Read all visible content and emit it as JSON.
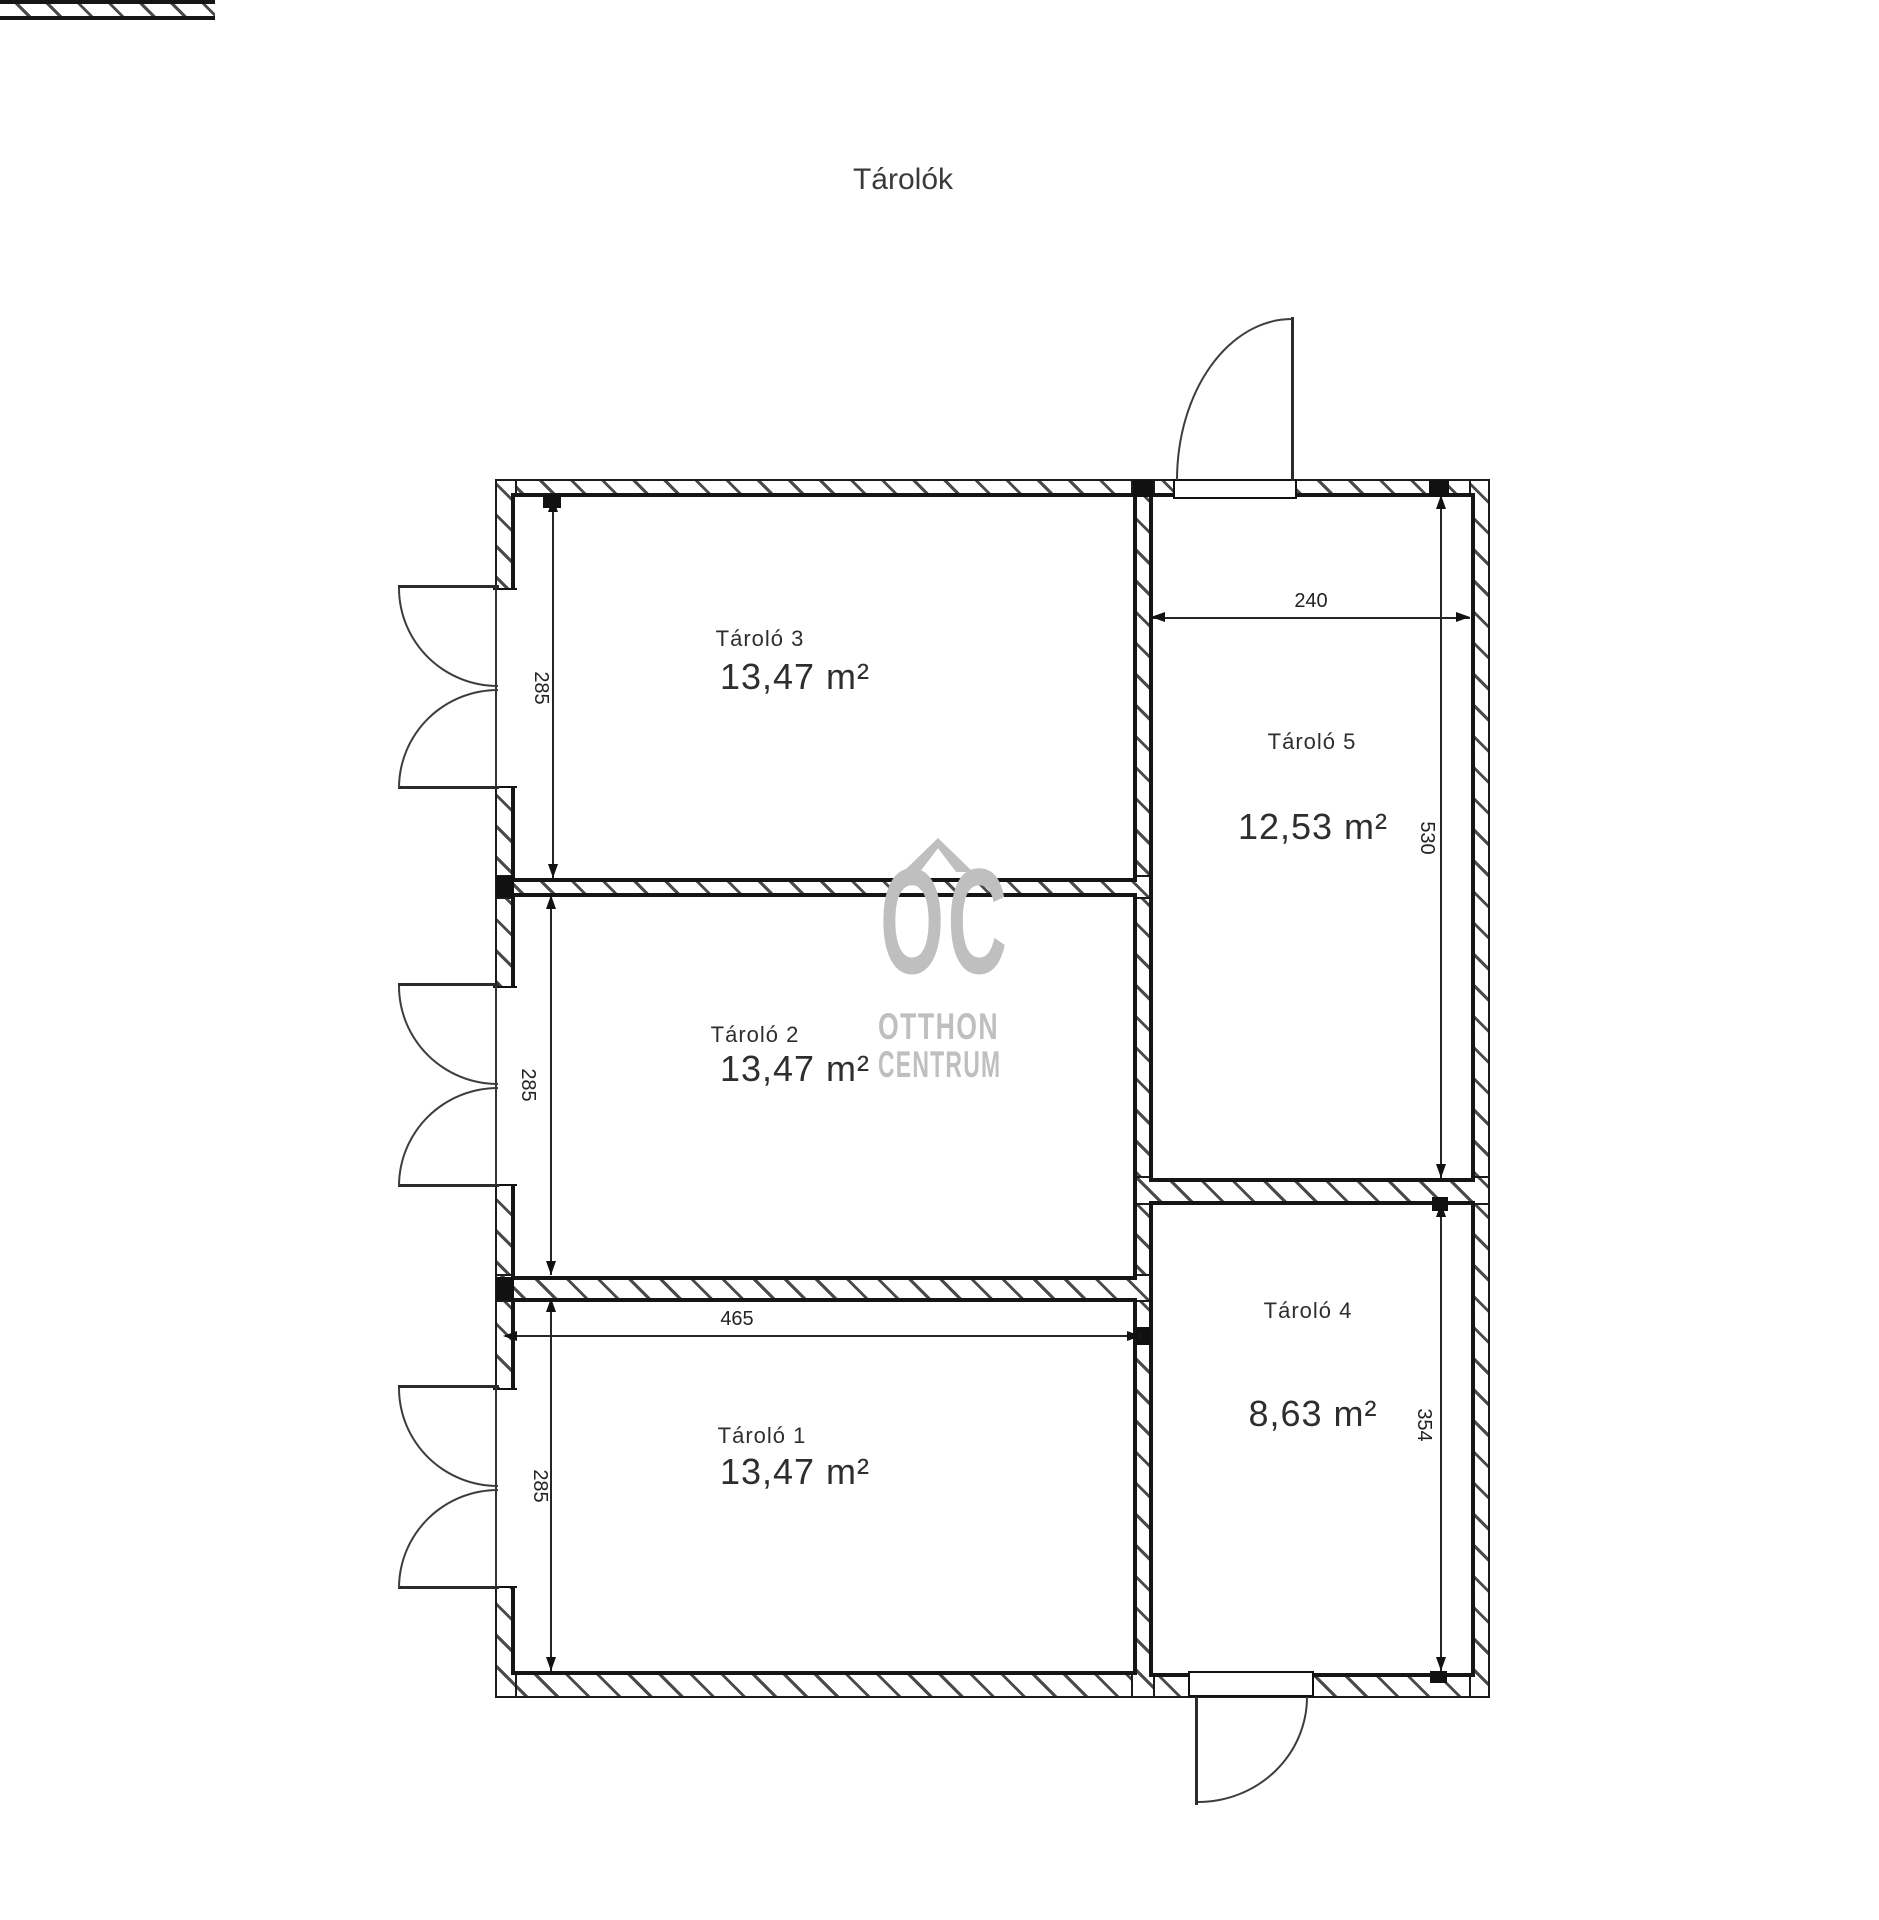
{
  "title": "Tárolók",
  "rooms": {
    "t1": {
      "name": "Tároló 1",
      "area": "13,47 m²"
    },
    "t2": {
      "name": "Tároló 2",
      "area": "13,47 m²"
    },
    "t3": {
      "name": "Tároló 3",
      "area": "13,47 m²"
    },
    "t4": {
      "name": "Tároló 4",
      "area": "8,63 m²"
    },
    "t5": {
      "name": "Tároló 5",
      "area": "12,53 m²"
    }
  },
  "dimensions": {
    "t3_height": "285",
    "t2_height": "285",
    "t1_height": "285",
    "t1_width": "465",
    "t5_width": "240",
    "t5_height": "530",
    "t4_height": "354"
  },
  "watermark": {
    "logo": "OC",
    "line1": "OTTHON",
    "line2": "CENTRUM"
  },
  "colors": {
    "line": "#151515",
    "text": "#2e2e2e",
    "watermark": "#bfbfbf"
  }
}
